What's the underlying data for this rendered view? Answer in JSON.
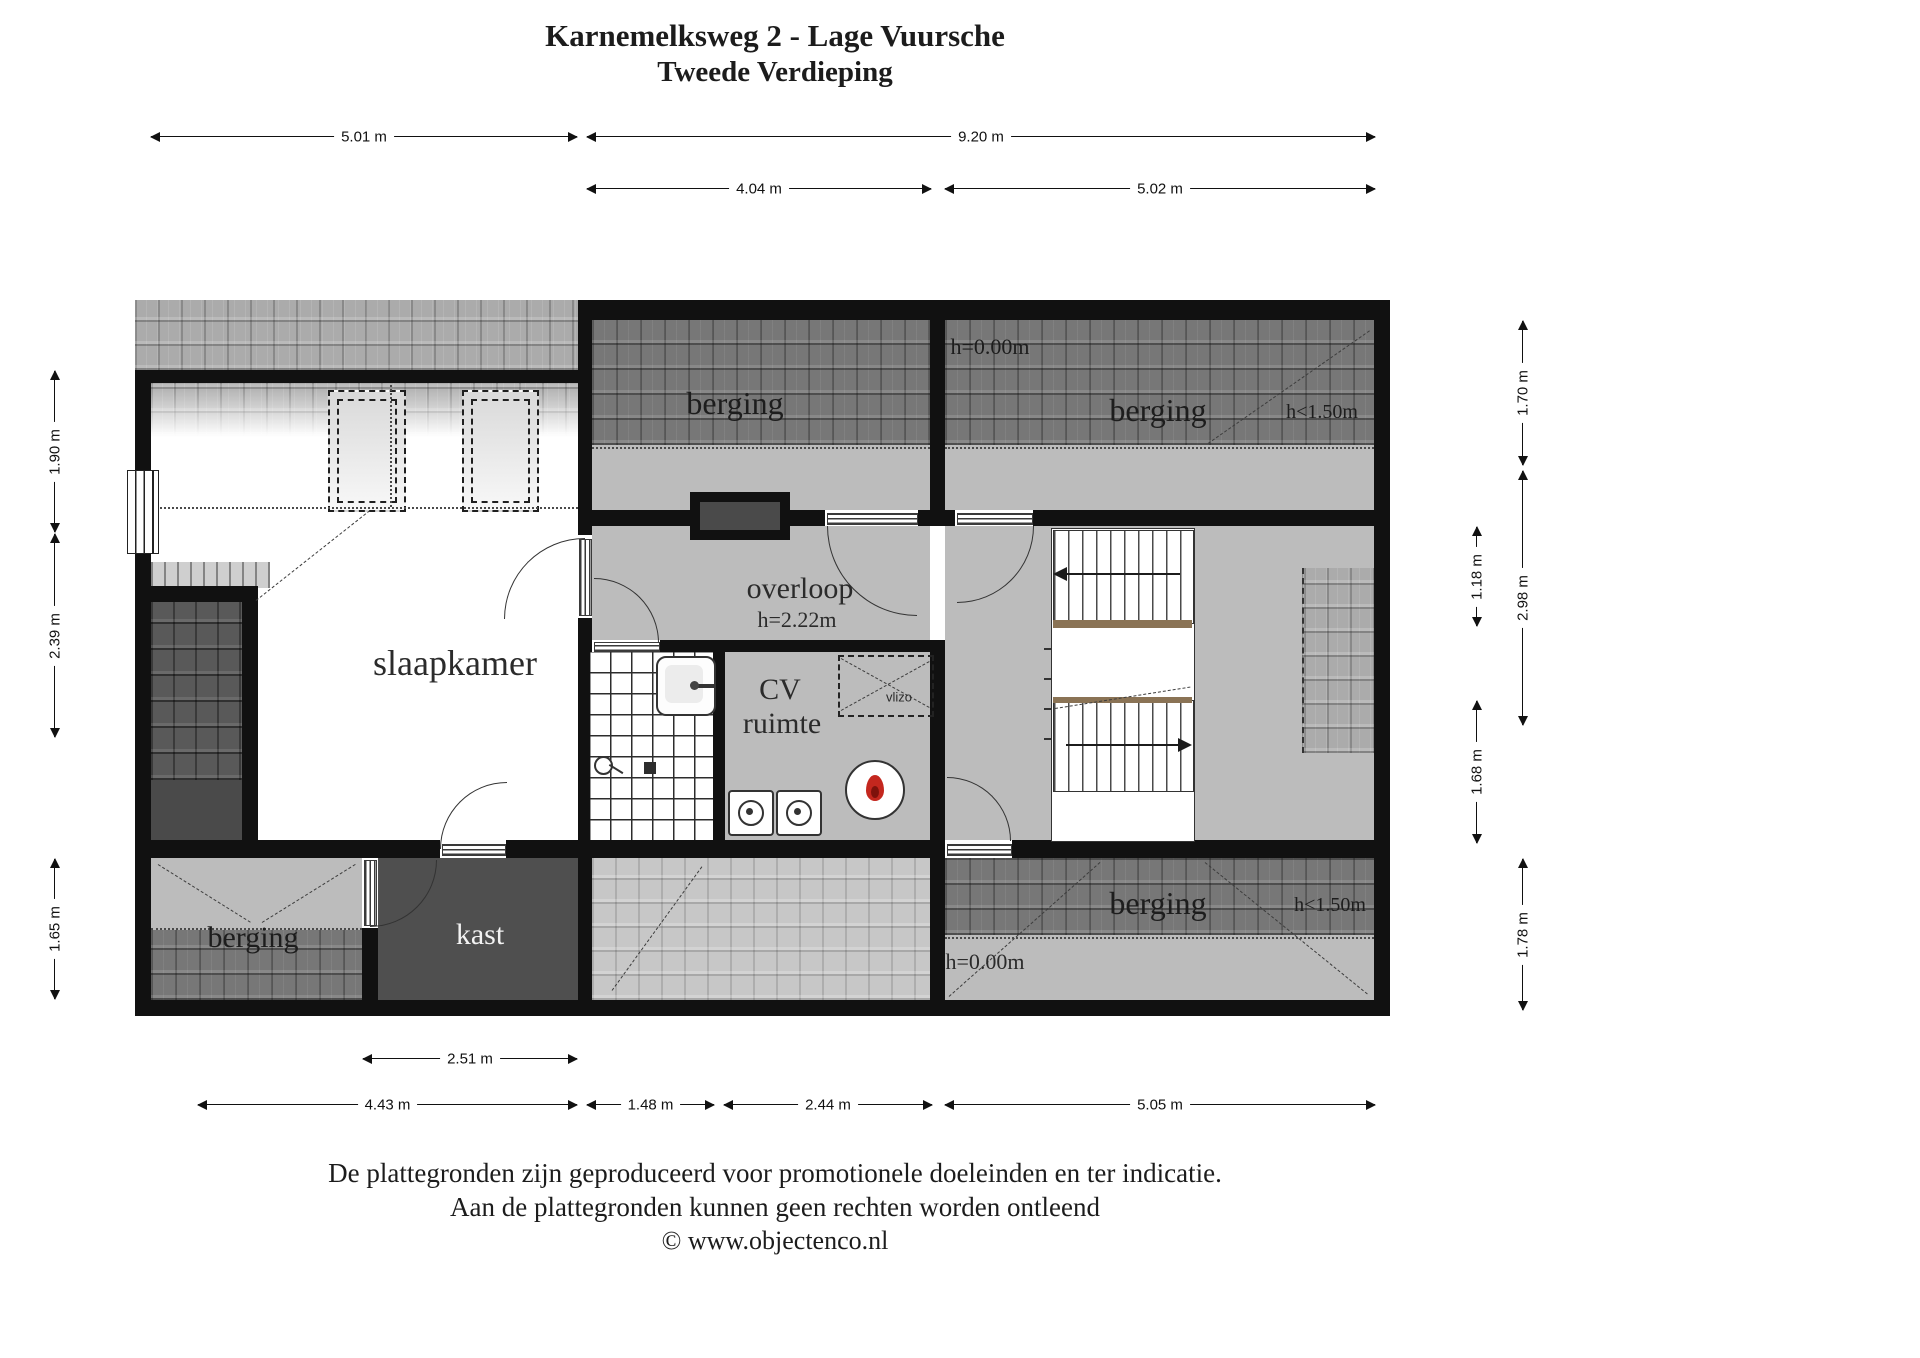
{
  "title": {
    "line1": "Karnemelksweg 2 - Lage Vuursche",
    "line2": "Tweede Verdieping"
  },
  "rooms": {
    "slaapkamer": "slaapkamer",
    "berging_middle": "berging",
    "berging_top_right": "berging",
    "berging_bottom_left": "berging",
    "berging_bottom_right": "berging",
    "kast": "kast",
    "overloop": "overloop",
    "overloop_height": "h=2.22m",
    "cv_line1": "CV",
    "cv_line2": "ruimte",
    "vlizo": "vlizo"
  },
  "annotations": {
    "h000_top": "h=0.00m",
    "h000_bottom": "h=0.00m",
    "h150_top": "h<1.50m",
    "h150_bottom": "h<1.50m"
  },
  "dimensions": {
    "top": [
      {
        "label": "5.01 m"
      },
      {
        "label": "9.20 m"
      },
      {
        "label": "4.04 m"
      },
      {
        "label": "5.02 m"
      }
    ],
    "left": [
      {
        "label": "1.90 m"
      },
      {
        "label": "2.39 m"
      },
      {
        "label": "1.65 m"
      }
    ],
    "right": [
      {
        "label": "1.70 m"
      },
      {
        "label": "1.18 m"
      },
      {
        "label": "2.98 m"
      },
      {
        "label": "1.68 m"
      },
      {
        "label": "1.78 m"
      }
    ],
    "bottom": [
      {
        "label": "2.51 m"
      },
      {
        "label": "4.43 m"
      },
      {
        "label": "1.48 m"
      },
      {
        "label": "2.44 m"
      },
      {
        "label": "5.05 m"
      }
    ]
  },
  "footer": {
    "line1": "De plattegronden zijn geproduceerd voor promotionele doeleinden en ter indicatie.",
    "line2": "Aan de plattegronden kunnen geen rechten worden ontleend",
    "line3": "© www.objectenco.nl"
  },
  "colors": {
    "wall": "#111111",
    "floor": "#bcbcbc",
    "tiles_dark": "#777777",
    "tiles_medium": "#ababab",
    "tiles_light": "#c7c7c7",
    "closet": "#4f4f4f",
    "flame": "#c4271e"
  }
}
